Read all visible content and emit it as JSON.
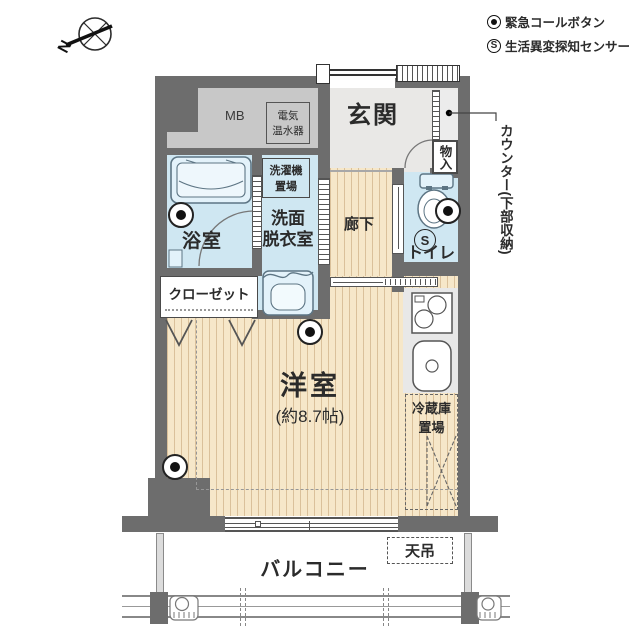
{
  "compass": {
    "north_label": "N"
  },
  "legend": {
    "emergency": {
      "label": "緊急コールボタン"
    },
    "sensor": {
      "symbol": "S",
      "label": "生活異変探知センサー"
    }
  },
  "rooms": {
    "entrance": {
      "label": "玄関"
    },
    "meter_box": {
      "label": "MB"
    },
    "water_heater": {
      "line1": "電気",
      "line2": "温水器"
    },
    "washing_machine": {
      "line1": "洗濯機",
      "line2": "置場"
    },
    "bathroom": {
      "label": "浴室"
    },
    "washroom": {
      "line1": "洗面",
      "line2": "脱衣室"
    },
    "corridor": {
      "label": "廊下"
    },
    "toilet": {
      "label": "トイレ",
      "sensor": "S"
    },
    "closet": {
      "label": "クローゼット"
    },
    "storage": {
      "label": "物入"
    },
    "counter": {
      "label": "カウンター(下部収納)"
    },
    "main_room": {
      "label": "洋室",
      "size": "(約8.7帖)"
    },
    "fridge": {
      "line1": "冷蔵庫",
      "line2": "置場"
    },
    "balcony": {
      "label": "バルコニー"
    },
    "ceiling_mount": {
      "label": "天吊"
    }
  },
  "colors": {
    "wall": "#6d6d6d",
    "water": "#cfe7f2",
    "wood": "#f6e7c9",
    "tile": "#e9e8e6",
    "meter": "#c8c8c8",
    "kitchen": "#e8e8e8",
    "ink": "#2b2b2b"
  }
}
